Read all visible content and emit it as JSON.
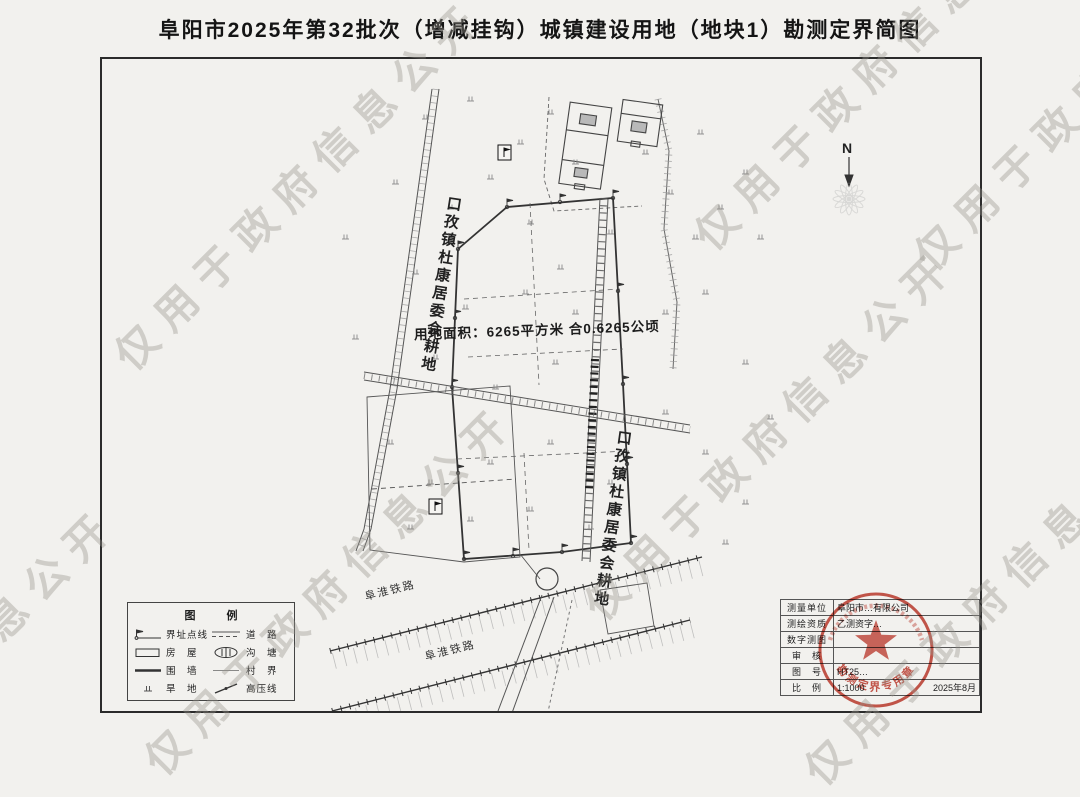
{
  "page": {
    "title": "阜阳市2025年第32批次（增减挂钩）城镇建设用地（地块1）勘测定界简图"
  },
  "watermark": {
    "color": "#96938a",
    "instances": [
      "仅用于政府信息公开",
      "仅用于政府信息公开",
      "信息公开",
      "仅用于政府信息公开",
      "仅用于政府信息公开",
      "仅用于政府",
      "仅用于政府信息公开"
    ]
  },
  "map": {
    "north_label": "N",
    "area_label": "用地面积：6265平方米 合0.6265公顷",
    "left_parcel_label": "口孜镇杜康居委会耕地",
    "right_parcel_label": "口孜镇杜康居委会耕地",
    "railway_label_upper": "阜淮铁路",
    "railway_label_lower": "阜淮铁路"
  },
  "legend": {
    "title": "图　例",
    "items": [
      {
        "label": "界址点线"
      },
      {
        "label": "道　路"
      },
      {
        "label": "房　屋"
      },
      {
        "label": "沟　塘"
      },
      {
        "label": "围　墙"
      },
      {
        "label": "村　界"
      },
      {
        "label": "旱　地"
      },
      {
        "label": "高压线"
      }
    ]
  },
  "titleblock": {
    "rows": [
      {
        "label": "测量单位",
        "value": "阜阳市…有限公司"
      },
      {
        "label": "测绘资质",
        "value": "乙测资字…"
      },
      {
        "label": "数字测图",
        "value": ""
      },
      {
        "label": "审　核",
        "value": ""
      },
      {
        "label": "图　号",
        "value": "HT25…"
      },
      {
        "label": "比　例",
        "value": "1:1000"
      }
    ],
    "date": "2025年8月"
  },
  "stamp": {
    "text": "勘测定界专用章",
    "color": "#c23b2e"
  }
}
